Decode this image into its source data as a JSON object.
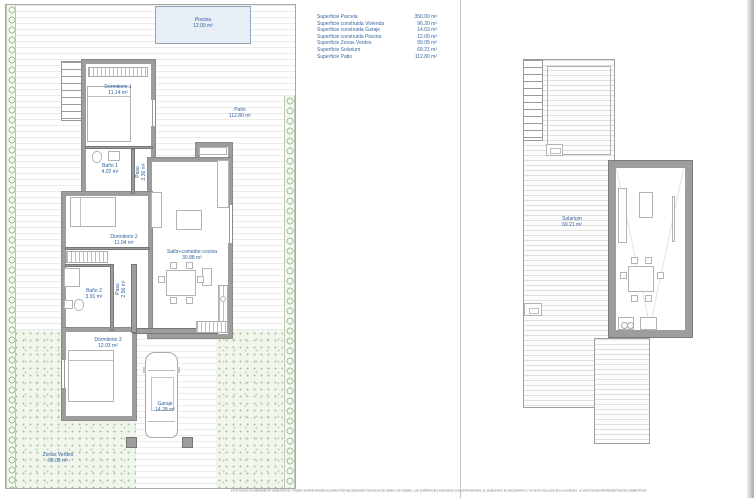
{
  "legend": {
    "rows": [
      {
        "label": "Superficie Parcela",
        "value": "350.00 m²"
      },
      {
        "label": "Superficie construida Vivienda",
        "value": "96.20 m²"
      },
      {
        "label": "Superficie construida Garaje",
        "value": "14.63 m²"
      },
      {
        "label": "Superficie construida Piscina",
        "value": "12.00 m²"
      },
      {
        "label": "Superficie Zonas Verdes",
        "value": "99.05 m²"
      },
      {
        "label": "Superficie Solarium",
        "value": "69.21 m²"
      },
      {
        "label": "Superficie Patio",
        "value": "112.80 m²"
      }
    ]
  },
  "floor_plan": {
    "rooms": [
      {
        "name": "Dormitorio 1",
        "area": "11.14 m²"
      },
      {
        "name": "Baño 1",
        "area": "4.02 m²"
      },
      {
        "name": "Paso",
        "area": "2.36 m²"
      },
      {
        "name": "Dormitorio 2",
        "area": "11.04 m²"
      },
      {
        "name": "Salón-comedor-cocina",
        "area": "30.88 m²"
      },
      {
        "name": "Baño 2",
        "area": "3.91 m²"
      },
      {
        "name": "Paso",
        "area": "2.56 m²"
      },
      {
        "name": "Dormitorio 3",
        "area": "12.03 m²"
      },
      {
        "name": "Garaje",
        "area": "14.28 m²"
      }
    ],
    "outdoor": [
      {
        "name": "Piscina",
        "area": "12.00 m²"
      },
      {
        "name": "Patio",
        "area": "112.80 m²"
      },
      {
        "name": "Zonas Verdes",
        "area": "99.05 m²"
      }
    ]
  },
  "roof_plan": {
    "rooms": [
      {
        "name": "Solarium",
        "area": "69.21 m²"
      }
    ]
  },
  "footer": {
    "disclaimer": "ESTE PLANO ES MERAMENTE ORIENTATIVO Y PODRA SUFRIR MODIFICACIONES POR NECESIDADES TECNICAS DE OBRA O DE DISEÑO. LAS SUPERFICIES INDICADAS SON APROXIMADAS. EL MOBILIARIO ES DECORATIVO Y NO ESTA INCLUIDO EN LA VIVIENDA. LA VEGETACION REPRESENTADA ES ORIENTATIVA."
  },
  "colors": {
    "label_blue": "#2f5e9b",
    "wall_gray": "#9d9d9d",
    "greenery": "#a9c39c",
    "pool_blue": "#e7eef5"
  }
}
